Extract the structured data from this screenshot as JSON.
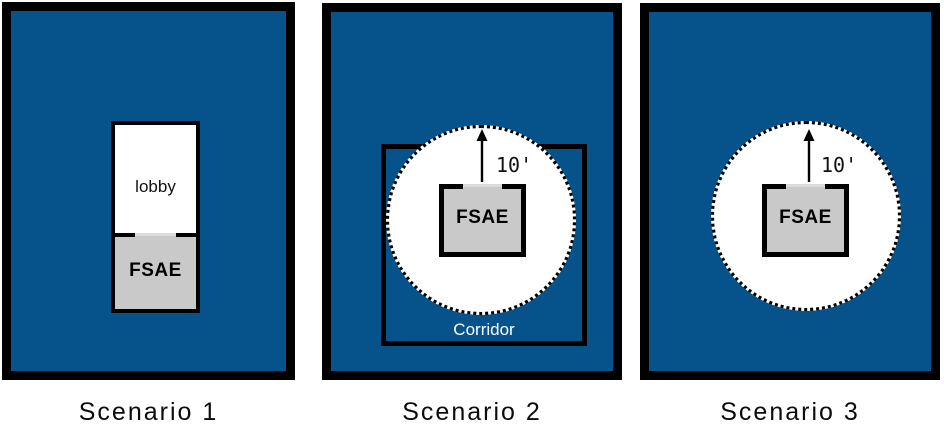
{
  "figure": {
    "colors": {
      "room_fill": "#05538A",
      "wall": "#000000",
      "fsae_fill": "#C9C9C9",
      "clearance_fill": "#FFFFFF",
      "door_threshold": "#DBDBDB",
      "corridor_label_color": "#FFFFFF",
      "caption_color": "#0B0B0B"
    },
    "scenarios": [
      {
        "caption": "Scenario 1",
        "lobby_label": "lobby",
        "fsae_label": "FSAE"
      },
      {
        "caption": "Scenario 2",
        "fsae_label": "FSAE",
        "corridor_label": "Corridor",
        "clearance_label": "10'"
      },
      {
        "caption": "Scenario 3",
        "fsae_label": "FSAE",
        "clearance_label": "10'"
      }
    ]
  }
}
